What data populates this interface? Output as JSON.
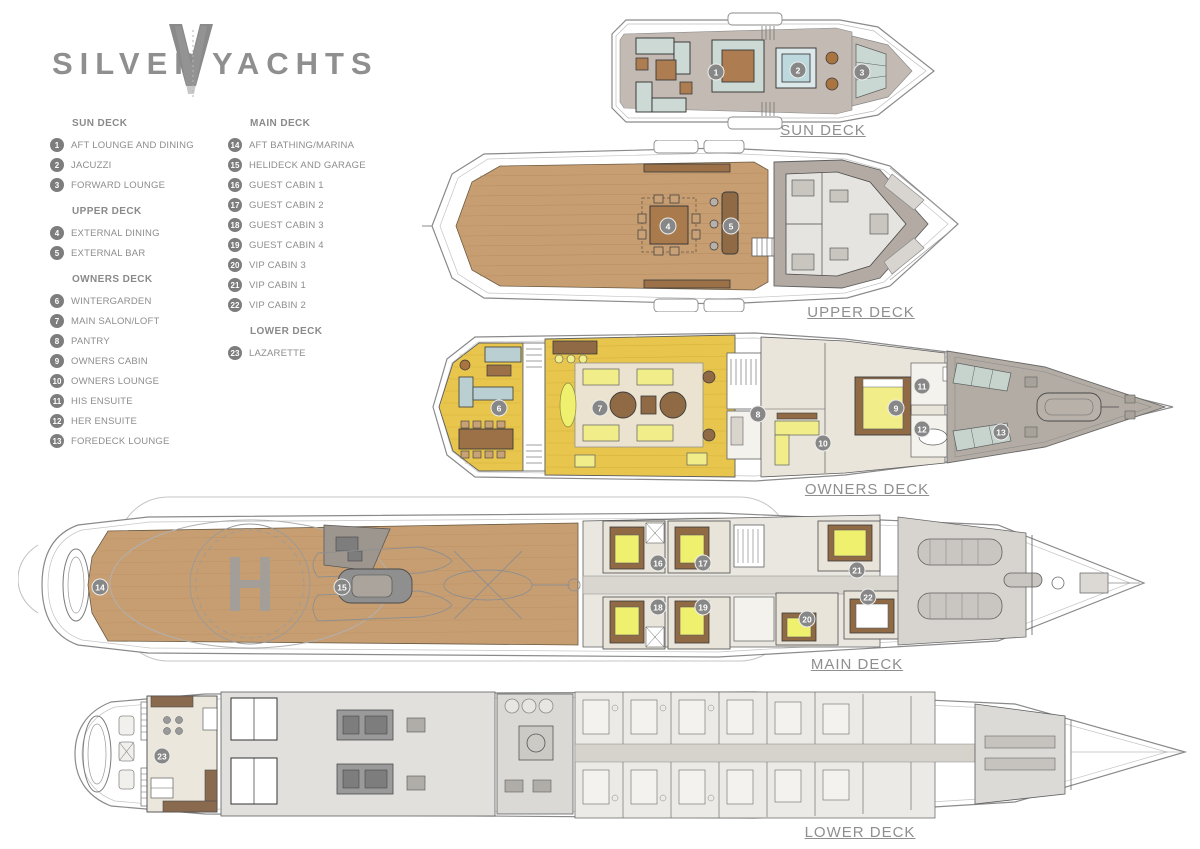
{
  "logo": {
    "left": "SILVER",
    "right": "YACHTS"
  },
  "legend": {
    "columns": [
      {
        "sections": [
          {
            "title": "SUN DECK",
            "items": [
              {
                "num": "1",
                "label": "AFT LOUNGE AND DINING"
              },
              {
                "num": "2",
                "label": "JACUZZI"
              },
              {
                "num": "3",
                "label": "FORWARD LOUNGE"
              }
            ]
          },
          {
            "title": "UPPER DECK",
            "items": [
              {
                "num": "4",
                "label": "EXTERNAL DINING"
              },
              {
                "num": "5",
                "label": "EXTERNAL BAR"
              }
            ]
          },
          {
            "title": "OWNERS DECK",
            "items": [
              {
                "num": "6",
                "label": "WINTERGARDEN"
              },
              {
                "num": "7",
                "label": "MAIN SALON/LOFT"
              },
              {
                "num": "8",
                "label": "PANTRY"
              },
              {
                "num": "9",
                "label": "OWNERS CABIN"
              },
              {
                "num": "10",
                "label": "OWNERS LOUNGE"
              },
              {
                "num": "11",
                "label": "HIS ENSUITE"
              },
              {
                "num": "12",
                "label": "HER ENSUITE"
              },
              {
                "num": "13",
                "label": "FOREDECK LOUNGE"
              }
            ]
          }
        ]
      },
      {
        "sections": [
          {
            "title": "MAIN DECK",
            "items": [
              {
                "num": "14",
                "label": "AFT BATHING/MARINA"
              },
              {
                "num": "15",
                "label": "HELIDECK AND GARAGE"
              },
              {
                "num": "16",
                "label": "GUEST CABIN 1"
              },
              {
                "num": "17",
                "label": "GUEST CABIN 2"
              },
              {
                "num": "18",
                "label": "GUEST CABIN 3"
              },
              {
                "num": "19",
                "label": "GUEST CABIN 4"
              },
              {
                "num": "20",
                "label": "VIP CABIN 3"
              },
              {
                "num": "21",
                "label": "VIP CABIN 1"
              },
              {
                "num": "22",
                "label": "VIP CABIN 2"
              }
            ]
          },
          {
            "title": "LOWER DECK",
            "items": [
              {
                "num": "23",
                "label": "LAZARETTE"
              }
            ]
          }
        ]
      }
    ]
  },
  "decks": [
    {
      "id": "sun-deck",
      "label": "SUN DECK",
      "markers": [
        {
          "num": "1",
          "x": 116,
          "y": 60
        },
        {
          "num": "2",
          "x": 198,
          "y": 58
        },
        {
          "num": "3",
          "x": 262,
          "y": 60
        }
      ]
    },
    {
      "id": "upper-deck",
      "label": "UPPER DECK",
      "markers": [
        {
          "num": "4",
          "x": 246,
          "y": 86
        },
        {
          "num": "5",
          "x": 309,
          "y": 86
        }
      ]
    },
    {
      "id": "owners-deck",
      "label": "OWNERS DECK",
      "markers": [
        {
          "num": "6",
          "x": 74,
          "y": 83
        },
        {
          "num": "7",
          "x": 175,
          "y": 83
        },
        {
          "num": "8",
          "x": 333,
          "y": 89
        },
        {
          "num": "9",
          "x": 471,
          "y": 83
        },
        {
          "num": "10",
          "x": 398,
          "y": 118
        },
        {
          "num": "11",
          "x": 497,
          "y": 61
        },
        {
          "num": "12",
          "x": 497,
          "y": 104
        },
        {
          "num": "13",
          "x": 576,
          "y": 107
        }
      ]
    },
    {
      "id": "main-deck",
      "label": "MAIN DECK",
      "markers": [
        {
          "num": "14",
          "x": 82,
          "y": 92
        },
        {
          "num": "15",
          "x": 324,
          "y": 92
        },
        {
          "num": "16",
          "x": 640,
          "y": 68
        },
        {
          "num": "17",
          "x": 685,
          "y": 68
        },
        {
          "num": "18",
          "x": 640,
          "y": 112
        },
        {
          "num": "19",
          "x": 685,
          "y": 112
        },
        {
          "num": "20",
          "x": 789,
          "y": 124
        },
        {
          "num": "21",
          "x": 839,
          "y": 75
        },
        {
          "num": "22",
          "x": 850,
          "y": 102
        }
      ]
    },
    {
      "id": "lower-deck",
      "label": "LOWER DECK",
      "markers": [
        {
          "num": "23",
          "x": 107,
          "y": 78
        }
      ]
    }
  ],
  "colors": {
    "label_gray": "#8f8f8f",
    "marker_gray": "#878787",
    "teak_wood": "#c79e72",
    "gold_deck": "#e8c64d",
    "superstructure_gray": "#b3aba3",
    "seating_blue": "#ccd9d5",
    "bed_yellow": "#eef06e",
    "cabin_beige": "#eae5da"
  }
}
